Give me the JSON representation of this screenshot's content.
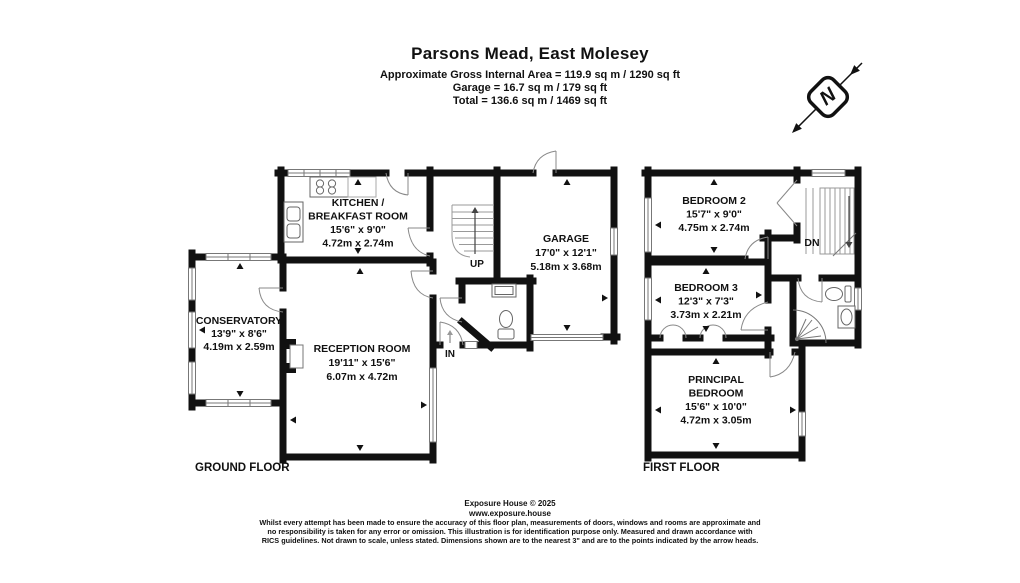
{
  "header": {
    "title": "Parsons Mead, East Molesey",
    "area_line": "Approximate Gross Internal Area = 119.9 sq m / 1290 sq ft",
    "garage_line": "Garage = 16.7 sq m / 179 sq ft",
    "total_line": "Total = 136.6 sq m / 1469 sq ft"
  },
  "compass": {
    "north_label": "N"
  },
  "ground_floor": {
    "label": "GROUND FLOOR",
    "kitchen": {
      "name1": "KITCHEN /",
      "name2": "BREAKFAST ROOM",
      "imperial": "15'6\" x 9'0\"",
      "metric": "4.72m x 2.74m"
    },
    "garage": {
      "name": "GARAGE",
      "imperial": "17'0\" x 12'1\"",
      "metric": "5.18m x 3.68m"
    },
    "conservatory": {
      "name": "CONSERVATORY",
      "imperial": "13'9\" x 8'6\"",
      "metric": "4.19m x 2.59m"
    },
    "reception": {
      "name": "RECEPTION ROOM",
      "imperial": "19'11\" x 15'6\"",
      "metric": "6.07m x 4.72m"
    },
    "up_label": "UP",
    "in_label": "IN"
  },
  "first_floor": {
    "label": "FIRST FLOOR",
    "bedroom2": {
      "name": "BEDROOM 2",
      "imperial": "15'7\" x 9'0\"",
      "metric": "4.75m x 2.74m"
    },
    "bedroom3": {
      "name": "BEDROOM 3",
      "imperial": "12'3\" x 7'3\"",
      "metric": "3.73m x 2.21m"
    },
    "principal": {
      "name1": "PRINCIPAL",
      "name2": "BEDROOM",
      "imperial": "15'6\" x 10'0\"",
      "metric": "4.72m x 3.05m"
    },
    "dn_label": "DN"
  },
  "footer": {
    "company": "Exposure House © 2025",
    "website": "www.exposure.house",
    "disclaimer1": "Whilst every attempt has been made to ensure the accuracy of this floor plan, measurements of doors, windows and rooms are approximate and",
    "disclaimer2": "no responsibility is taken for any error or omission. This illustration is for identification purpose only. Measured and drawn accordance with",
    "disclaimer3": "RICS guidelines. Not drawn to scale, unless stated. Dimensions shown are to the nearest 3\" and are to the points indicated by the arrow heads."
  }
}
